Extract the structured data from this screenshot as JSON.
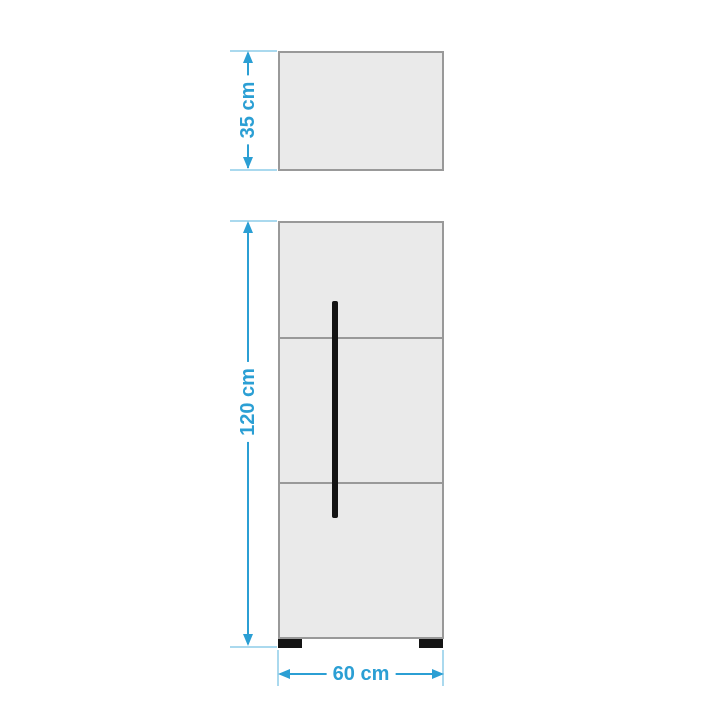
{
  "diagram": {
    "labels": {
      "top_box_height": "35 cm",
      "body_height": "120 cm",
      "body_width": "60 cm"
    },
    "colors": {
      "accent": "#2b9fd4",
      "extension": "#aad9ee",
      "panel_fill": "#eaeaea",
      "panel_border": "#999999",
      "handle": "#141414",
      "background": "#ffffff"
    }
  }
}
